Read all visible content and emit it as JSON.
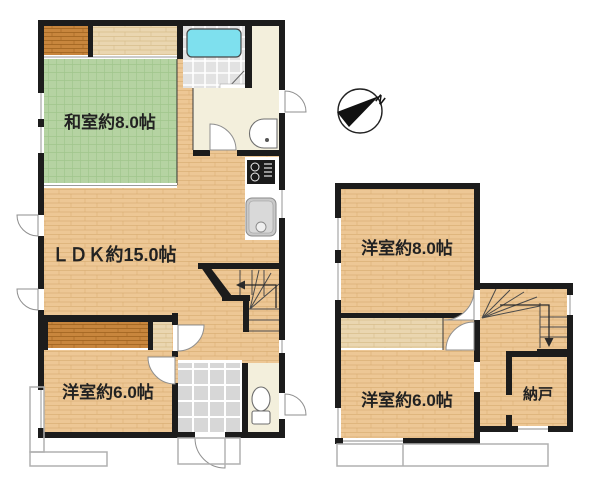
{
  "plan_title": "floor-plan",
  "floor1": {
    "washitsu_label": "和室約8.0帖",
    "ldk_label": "ＬＤＫ約15.0帖",
    "yoshitsu6_label": "洋室約6.0帖"
  },
  "floor2": {
    "yoshitsu8_label": "洋室約8.0帖",
    "yoshitsu6_label": "洋室約6.0帖",
    "nando_label": "納戸"
  },
  "compass": {
    "north_label": "N"
  },
  "colors": {
    "wall": "#1c1c1c",
    "wood": "#edc795",
    "wood_light": "#ead6b0",
    "wood_dark": "#c8863d",
    "tatami": "#b5d3a2",
    "tatami_line": "#9dc489",
    "entry_tile": "#d7d7d7",
    "bath_tile": "#e2e2e2",
    "cream": "#f3efdc",
    "bathtub": "#7ee0ee"
  }
}
